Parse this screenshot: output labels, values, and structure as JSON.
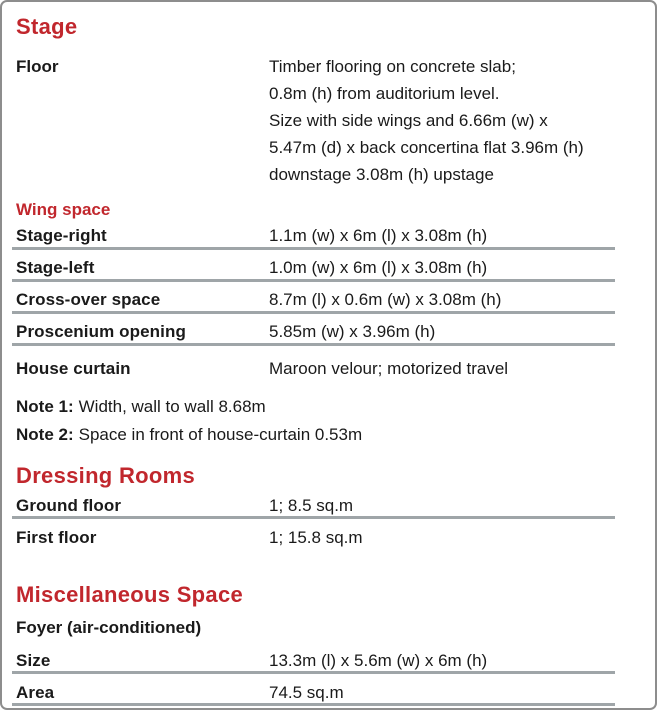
{
  "colors": {
    "accent": "#c1272d",
    "rule": "#9fa5a8",
    "border": "#8d8d8d",
    "text": "#1a1a1a"
  },
  "stage": {
    "title": "Stage",
    "floor": {
      "label": "Floor",
      "lines": [
        "Timber flooring on concrete slab;",
        "0.8m (h) from auditorium level.",
        "Size with side wings and 6.66m (w) x",
        "5.47m (d) x back concertina flat 3.96m (h)",
        "downstage 3.08m (h) upstage"
      ]
    }
  },
  "wing_space": {
    "title": "Wing space",
    "rows": [
      {
        "label": "Stage-right",
        "value": "1.1m (w) x 6m (l) x 3.08m (h)"
      },
      {
        "label": "Stage-left",
        "value": "1.0m (w) x 6m (l) x 3.08m (h)"
      },
      {
        "label": "Cross-over space",
        "value": "8.7m (l) x 0.6m (w) x 3.08m (h)"
      },
      {
        "label": "Proscenium opening",
        "value": "5.85m (w) x 3.96m (h)"
      }
    ],
    "house_curtain": {
      "label": "House curtain",
      "value": "Maroon velour; motorized travel"
    },
    "notes": [
      {
        "label": "Note 1:",
        "text": "Width, wall to wall 8.68m"
      },
      {
        "label": "Note 2:",
        "text": "Space in front of house-curtain 0.53m"
      }
    ]
  },
  "dressing_rooms": {
    "title": "Dressing Rooms",
    "rows": [
      {
        "label": "Ground floor",
        "value": "1; 8.5 sq.m"
      },
      {
        "label": "First floor",
        "value": "1; 15.8 sq.m"
      }
    ]
  },
  "miscellaneous": {
    "title": "Miscellaneous Space",
    "subtitle": "Foyer (air-conditioned)",
    "rows": [
      {
        "label": "Size",
        "value": "13.3m (l) x 5.6m (w) x 6m (h)"
      },
      {
        "label": "Area",
        "value": "74.5 sq.m"
      }
    ]
  }
}
